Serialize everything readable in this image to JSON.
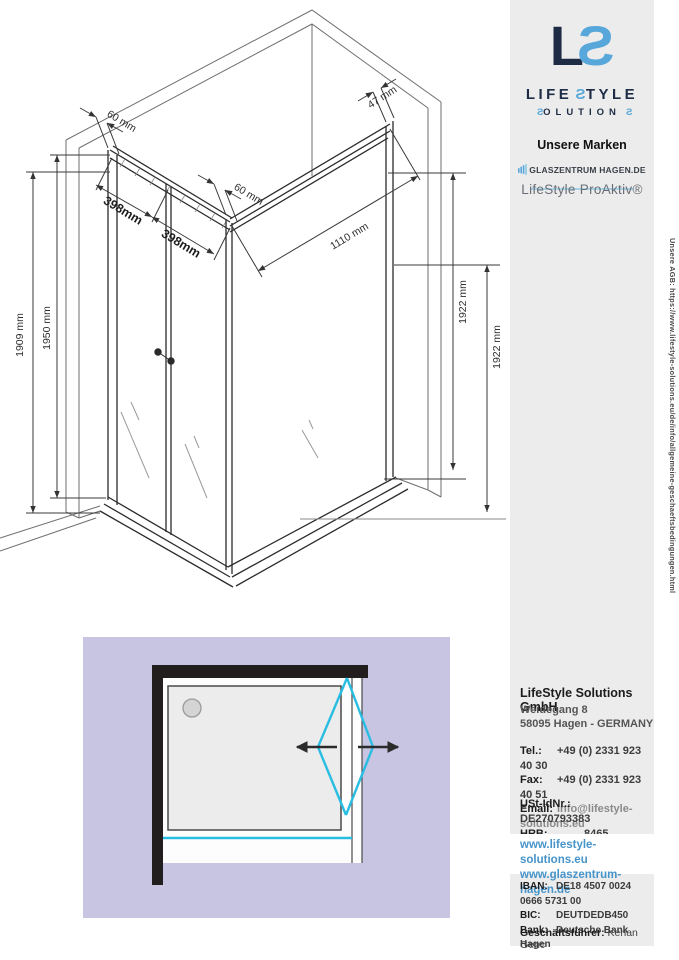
{
  "drawing": {
    "labels": {
      "d60_left": "60 mm",
      "d60_right": "60 mm",
      "d398_a": "398mm",
      "d398_b": "398mm",
      "d47": "47 mm",
      "d1110": "1110 mm",
      "d1909": "1909 mm",
      "d1950": "1950 mm",
      "d1922_front": "1922 mm",
      "d1922_wall": "1922 mm"
    }
  },
  "sidebar": {
    "logo": {
      "mark_l": "L",
      "mark_s": "S",
      "line1": {
        "pre": "LIFE",
        "s": "S",
        "post": "TYLE"
      },
      "line2": {
        "s1": "S",
        "mid": "OLUTION",
        "s2": "S"
      }
    },
    "brands": {
      "heading": "Unsere Marken",
      "brand1": "GLASZENTRUM HAGEN.DE",
      "brand2": "LifeStyle ProAktiv®"
    },
    "agb_vertical": "Unsere AGB: https://www.lifestyle-solutions.eu/de/info/allgemeine-geschaeftsbedingungen.html",
    "company": {
      "name": "LifeStyle Solutions GmbH",
      "street": "Weidegang 8",
      "city": "58095 Hagen - GERMANY"
    },
    "contact": {
      "tel_label": "Tel.:",
      "tel": "+49 (0) 2331 923 40 30",
      "fax_label": "Fax:",
      "fax": "+49 (0) 2331 923 40 51",
      "email_label": "Email:",
      "email": "info@lifestyle-solutions.eu"
    },
    "registry": {
      "ustid_label": "USt-IdNr.:",
      "ustid": "DE270793383",
      "hrb_label": "HRB:",
      "hrb": "8465"
    },
    "links": {
      "site1": "www.lifestyle-solutions.eu",
      "site2": "www.glaszentrum-hagen.de"
    },
    "bank": {
      "iban_label": "IBAN:",
      "iban": "DE18 4507 0024 0666 5731 00",
      "bic_label": "BIC:",
      "bic": "DEUTDEDB450",
      "bank_label": "Bank:",
      "bank": "Deutsche Bank Hagen"
    },
    "ceo": {
      "label": "Geschäftsführer:",
      "name": "Kenan Genc"
    }
  },
  "colors": {
    "page_bg": "#ffffff",
    "sidebar_bg": "#ececec",
    "logo_navy": "#1d2b45",
    "logo_blue": "#57a7db",
    "link_blue": "#4694c9",
    "drawing_line": "#3a3a3a",
    "topview_bg": "#c7c5e2",
    "topview_wall": "#231e1e",
    "topview_cyan": "#29bde2",
    "tray_fill": "#ececec"
  }
}
